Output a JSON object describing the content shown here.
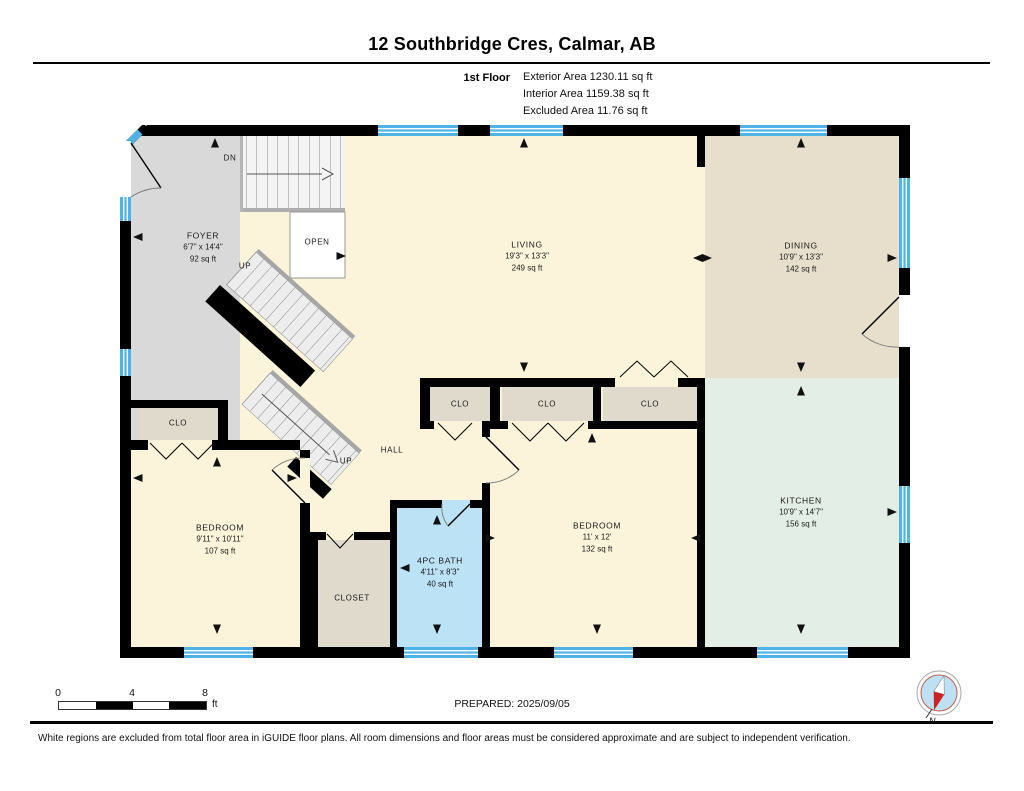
{
  "header": {
    "title": "12 Southbridge Cres, Calmar, AB",
    "floor_label": "1st Floor",
    "exterior_area": "Exterior Area 1230.11 sq ft",
    "interior_area": "Interior Area 1159.38 sq ft",
    "excluded_area": "Excluded Area 11.76 sq ft"
  },
  "rooms": {
    "foyer": {
      "name": "FOYER",
      "dims": "6'7\" x 14'4\"",
      "area": "92 sq ft"
    },
    "living": {
      "name": "LIVING",
      "dims": "19'3\" x 13'3\"",
      "area": "249 sq ft"
    },
    "dining": {
      "name": "DINING",
      "dims": "10'9\" x 13'3\"",
      "area": "142 sq ft"
    },
    "kitchen": {
      "name": "KITCHEN",
      "dims": "10'9\" x 14'7\"",
      "area": "156 sq ft"
    },
    "bedroom1": {
      "name": "BEDROOM",
      "dims": "9'11\" x 10'11\"",
      "area": "107 sq ft"
    },
    "bedroom2": {
      "name": "BEDROOM",
      "dims": "11' x 12'",
      "area": "132 sq ft"
    },
    "bath": {
      "name": "4PC BATH",
      "dims": "4'11\" x 8'3\"",
      "area": "40 sq ft"
    }
  },
  "labels": {
    "dn": "DN",
    "up_upper": "UP",
    "up_lower": "UP",
    "open": "OPEN",
    "hall": "HALL",
    "closet": "CLOSET",
    "clo_foyer": "CLO",
    "clo_1": "CLO",
    "clo_2": "CLO",
    "clo_3": "CLO"
  },
  "scale_bar": {
    "tick_0": "0",
    "tick_4": "4",
    "tick_8": "8",
    "unit": "ft"
  },
  "compass": {
    "north_label": "N"
  },
  "footer": {
    "prepared": "PREPARED: 2025/09/05",
    "disclaimer": "White regions are excluded from total floor area in iGUIDE floor plans. All room dimensions and floor areas must be considered approximate and are subject to independent verification."
  },
  "colors": {
    "wall": "#000000",
    "window_blue": "#4FB3E6",
    "foyer_gray": "#D9D9D9",
    "living_cream": "#FBF4DA",
    "dining_tan": "#E7DFCC",
    "kitchen_mint": "#E3EEE6",
    "bath_blue": "#BCE2F6",
    "closet_tan": "#DFDACC",
    "compass_red": "#CC2222",
    "compass_blue": "#BEE0F4"
  }
}
